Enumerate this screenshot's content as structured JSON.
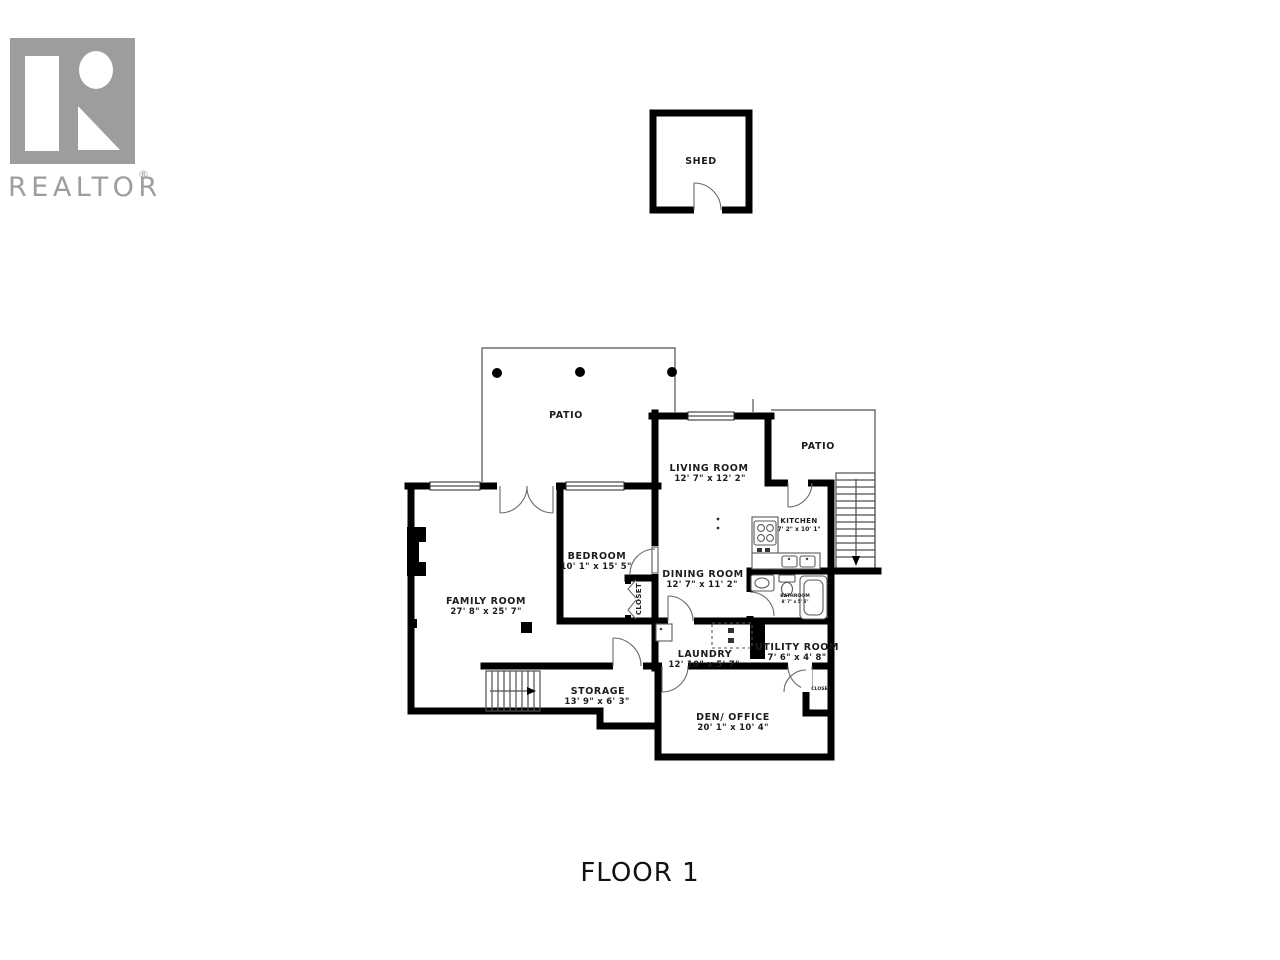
{
  "branding": {
    "name": "REALTOR",
    "registered": "®"
  },
  "floor_title": "FLOOR 1",
  "rooms": {
    "shed": {
      "label": "SHED"
    },
    "patio_top": {
      "label": "PATIO"
    },
    "patio_right": {
      "label": "PATIO"
    },
    "living": {
      "label": "LIVING ROOM",
      "dims": "12' 7\" x 12' 2\""
    },
    "kitchen": {
      "label": "KITCHEN",
      "dims": "7' 2\" x 10' 1\""
    },
    "bedroom": {
      "label": "BEDROOM",
      "dims": "10' 1\" x 15' 5\""
    },
    "dining": {
      "label": "DINING ROOM",
      "dims": "12' 7\" x 11' 2\""
    },
    "family": {
      "label": "FAMILY ROOM",
      "dims": "27' 8\" x 25' 7\""
    },
    "bathroom": {
      "label": "BATHROOM",
      "dims": "8' 7\" x 5' 5\""
    },
    "closet_bedroom": {
      "label": "CLOSET"
    },
    "laundry": {
      "label": "LAUNDRY",
      "dims": "12' 10\" x 5' 7\""
    },
    "utility": {
      "label": "UTILITY ROOM",
      "dims": "7' 6\" x 4' 8\""
    },
    "storage": {
      "label": "STORAGE",
      "dims": "13' 9\" x 6' 3\""
    },
    "den": {
      "label": "DEN/ OFFICE",
      "dims": "20' 1\" x 10' 4\""
    },
    "closet_den": {
      "label": "CLOSET"
    }
  },
  "colors": {
    "wall": "#000000",
    "logo_gray": "#9d9d9d"
  }
}
